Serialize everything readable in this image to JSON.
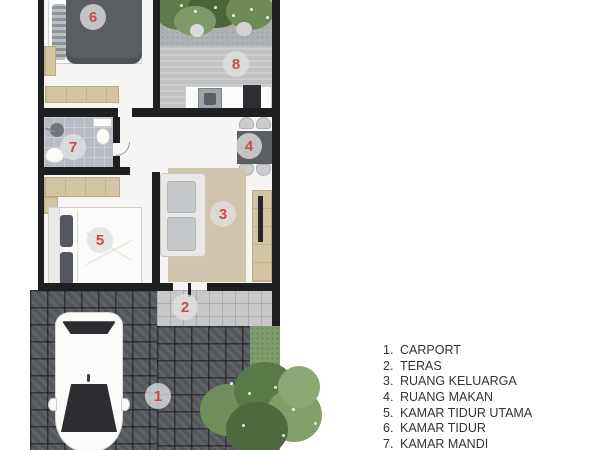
{
  "legend": {
    "items": [
      {
        "number": "1.",
        "label": "CARPORT"
      },
      {
        "number": "2.",
        "label": "TERAS"
      },
      {
        "number": "3.",
        "label": "RUANG KELUARGA"
      },
      {
        "number": "4.",
        "label": "RUANG MAKAN"
      },
      {
        "number": "5.",
        "label": "KAMAR TIDUR UTAMA"
      },
      {
        "number": "6.",
        "label": "KAMAR TIDUR"
      },
      {
        "number": "7.",
        "label": "KAMAR MANDI"
      }
    ]
  },
  "markers": [
    {
      "number": "1"
    },
    {
      "number": "2"
    },
    {
      "number": "3"
    },
    {
      "number": "4"
    },
    {
      "number": "5"
    },
    {
      "number": "6"
    },
    {
      "number": "7"
    },
    {
      "number": "8"
    }
  ],
  "colors": {
    "marker_number": "#cf4a47",
    "wall": "#1e1f21",
    "wood": "#d3c4a3",
    "rug": "#cfc5ad",
    "grass": "#7f9c6d",
    "paving_dark": "#53565a",
    "teras_floor": "#c6c8ca",
    "bath_floor": "#b7bbc3"
  }
}
